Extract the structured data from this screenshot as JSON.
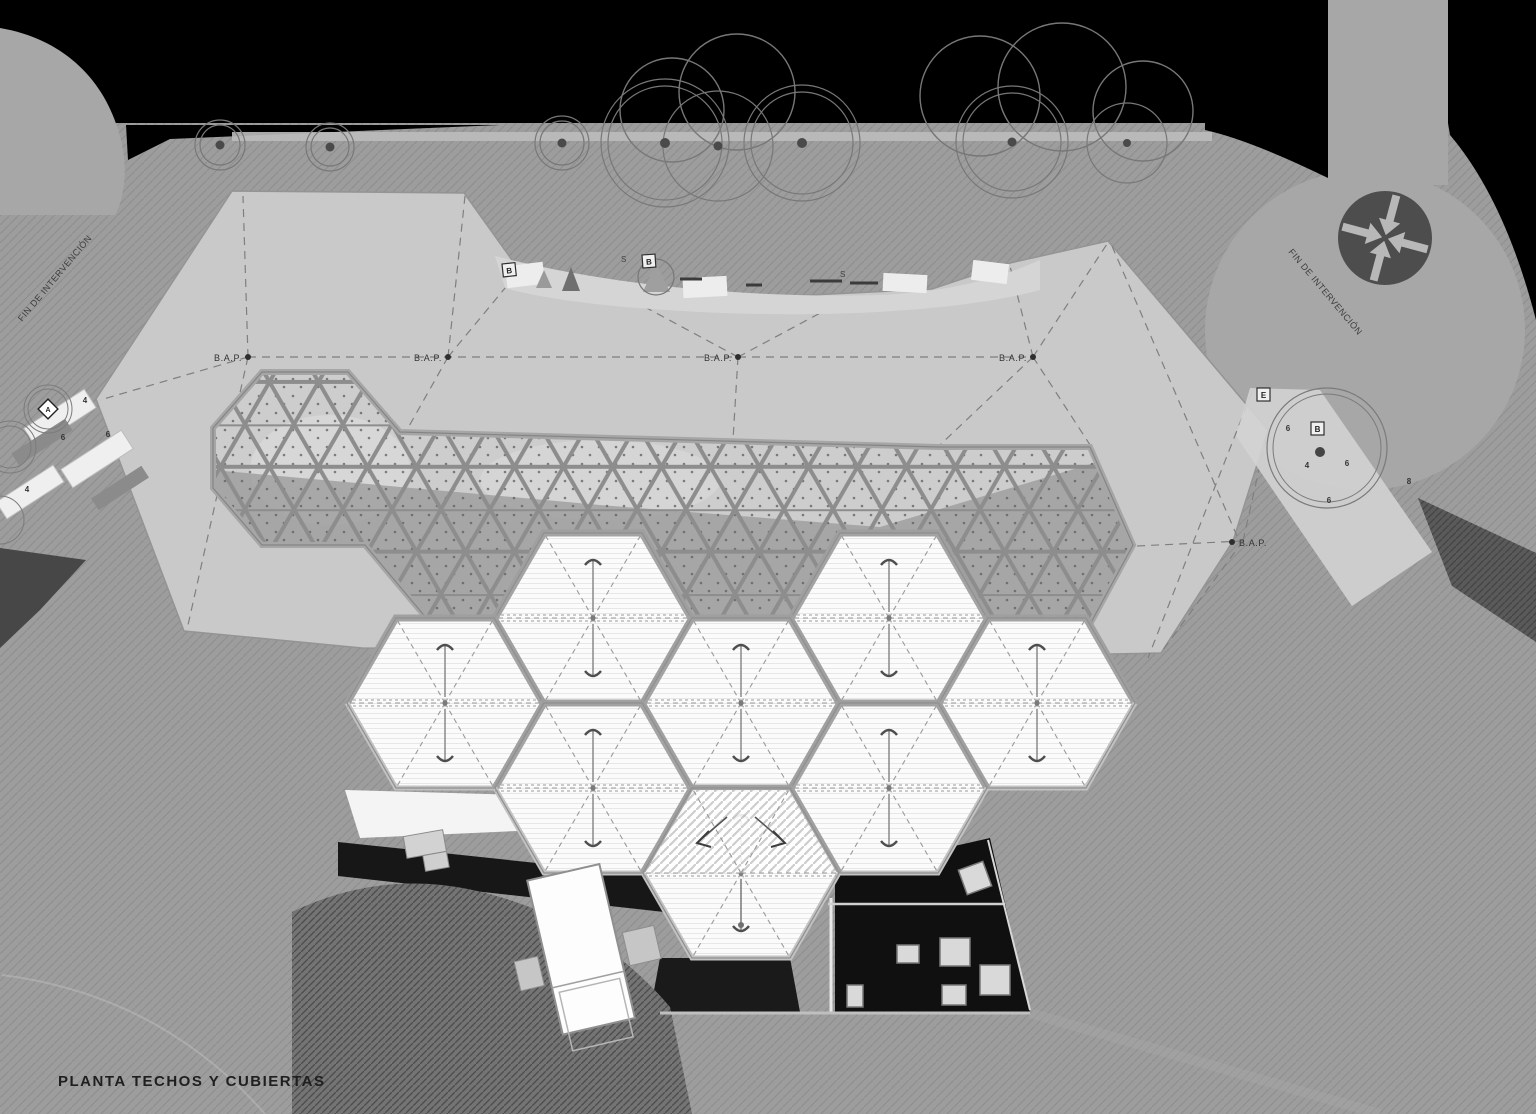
{
  "drawing": {
    "title": "PLANTA TECHOS Y CUBIERTAS",
    "annotations": {
      "bap": "B.A.P.",
      "fin": "FIN DE INTERVENCIÓN",
      "letter_b": "B",
      "letter_s": "S",
      "letter_a": "A",
      "letter_e": "E",
      "num_4": "4",
      "num_6": "6",
      "num_8": "8"
    },
    "colors": {
      "canvas": "#000000",
      "terrain": "#9d9d9d",
      "upper_ground": "#a7a7a7",
      "roof_plate": "#c9c9c9",
      "canopy_white": "#fbfbfb",
      "space_frame": "#8f8f8f",
      "shadow_black": "#101010",
      "symbol_dark": "#4d4d4d"
    }
  }
}
